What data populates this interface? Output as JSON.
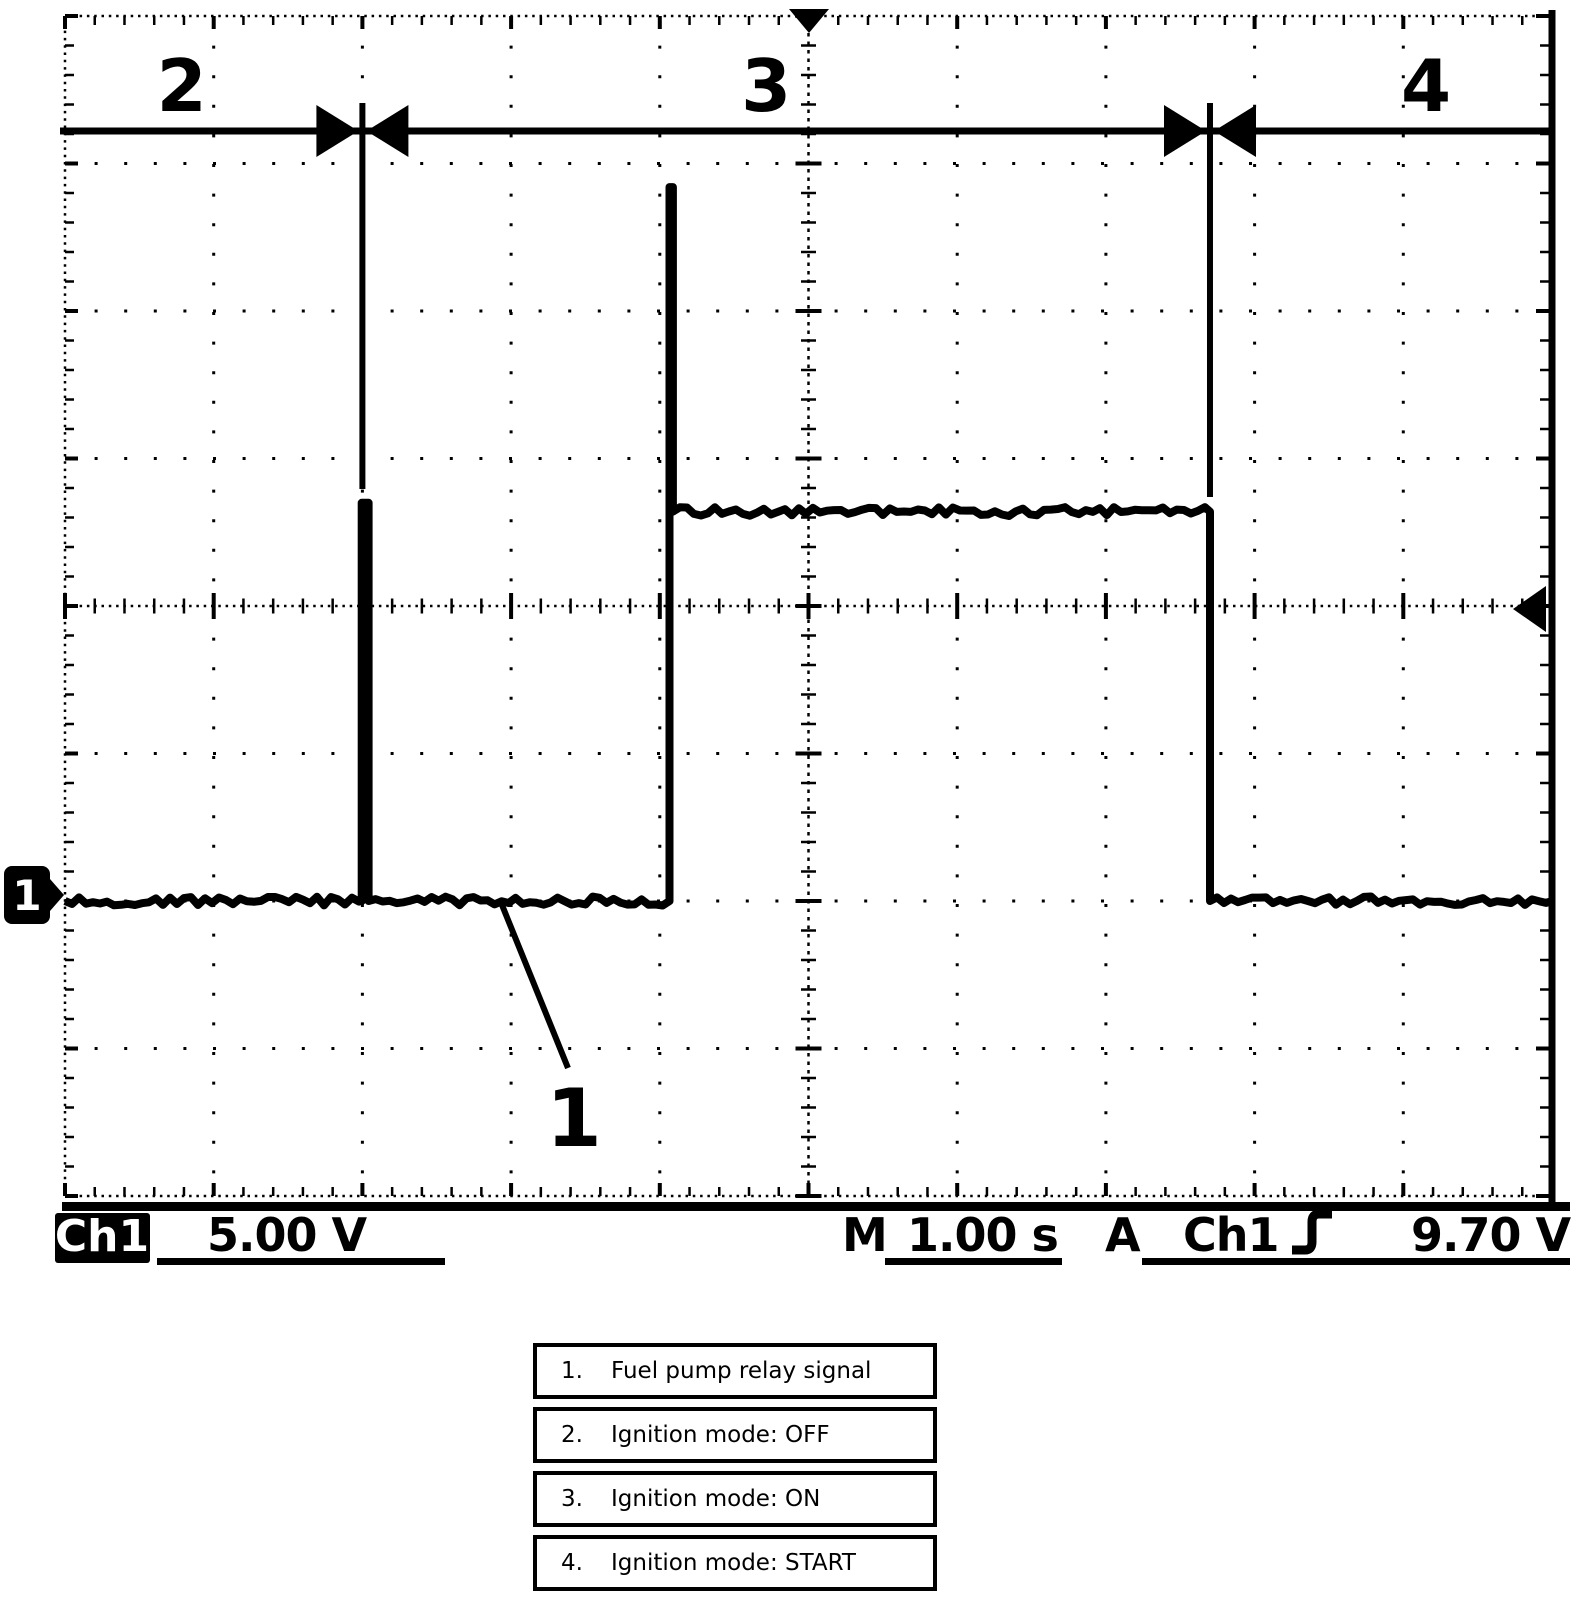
{
  "oscilloscope": {
    "readout": {
      "channel_label": "Ch1",
      "volts_per_div": "5.00 V",
      "timebase_prefix": "M",
      "time_per_div": "1.00 s",
      "trigger_prefix": "A",
      "trigger_source": "Ch1",
      "trigger_level": "9.70 V"
    },
    "channel_ground_marker": "1",
    "icons": {
      "trigger_position": "down-triangle-top-center",
      "trigger_level": "left-arrow-right-edge",
      "trigger_slope": "rising-edge-glyph",
      "channel_ground": "right-arrow-box"
    }
  },
  "legend": {
    "rows": [
      {
        "num": "1.",
        "label": "Fuel pump relay signal"
      },
      {
        "num": "2.",
        "label": "Ignition mode: OFF"
      },
      {
        "num": "3.",
        "label": "Ignition mode: ON"
      },
      {
        "num": "4.",
        "label": "Ignition mode: START"
      }
    ]
  },
  "chart_data": {
    "type": "line",
    "title": "Fuel pump relay signal vs ignition mode",
    "x_units": "s",
    "y_units": "V",
    "seconds_per_div": 1.0,
    "volts_per_div": 5.0,
    "divisions_x": 10,
    "divisions_y": 8,
    "trigger": {
      "source": "Ch1",
      "slope": "rising",
      "level_V": 9.7,
      "position_div_from_left": 5
    },
    "ground_div_below_center": 2,
    "signal_levels_V": {
      "low": 0,
      "high": 13.2,
      "prime_pulse_peak": 13.5,
      "turn_on_spike_peak": 24.2
    },
    "segments": [
      [
        -5.0,
        0
      ],
      [
        -3.005,
        0
      ],
      [
        -3.005,
        13.5
      ],
      [
        -2.958,
        13.5
      ],
      [
        -2.958,
        0
      ],
      [
        -0.935,
        0
      ],
      [
        -0.935,
        24.2
      ],
      [
        -0.912,
        24.2
      ],
      [
        -0.912,
        13.2
      ],
      [
        2.7,
        13.2
      ],
      [
        2.7,
        0
      ],
      [
        5.0,
        0
      ]
    ],
    "regions": [
      {
        "label": "2",
        "meaning": "Ignition mode: OFF",
        "t_range": [
          -5.0,
          -3.0
        ]
      },
      {
        "label": "3",
        "meaning": "Ignition mode: ON",
        "t_range": [
          -3.0,
          2.7
        ]
      },
      {
        "label": "4",
        "meaning": "Ignition mode: START",
        "t_range": [
          2.7,
          5.0
        ]
      }
    ],
    "callout": {
      "label": "1",
      "points_to": "fuel pump relay trace (low level)"
    }
  }
}
